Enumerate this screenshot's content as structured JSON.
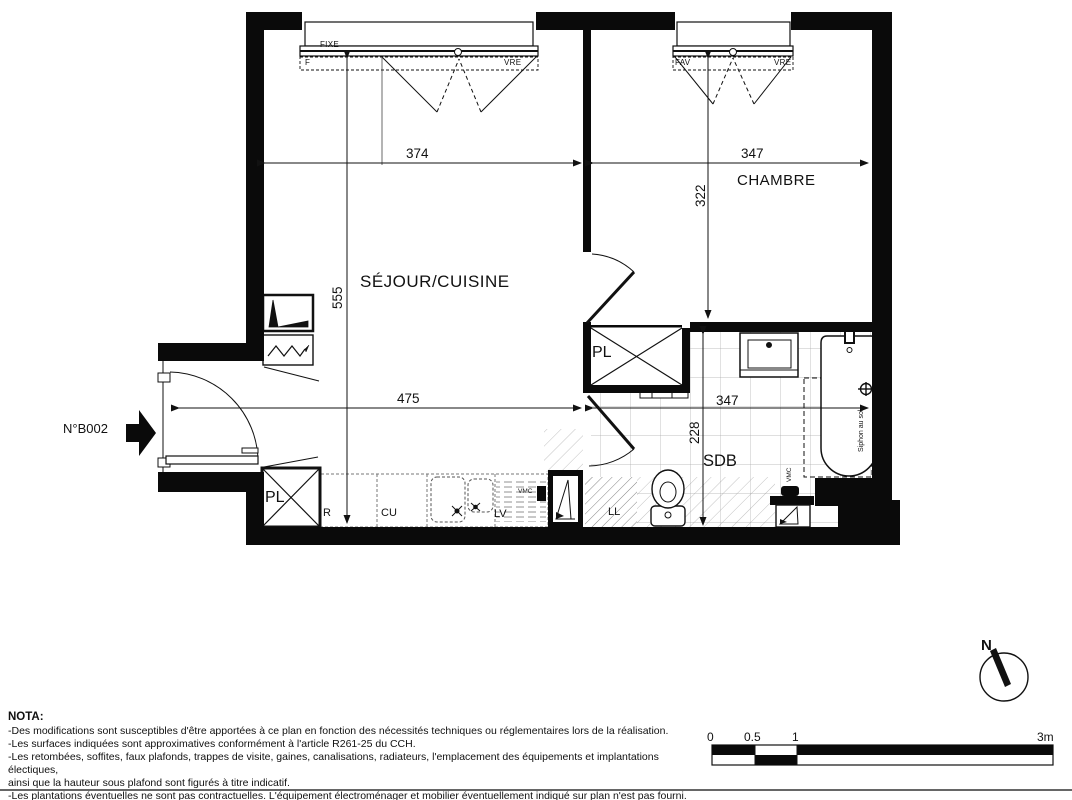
{
  "unit": {
    "label": "N°B002"
  },
  "rooms": {
    "sejour": "SÉJOUR/CUISINE",
    "chambre": "CHAMBRE",
    "sdb": "SDB",
    "pl_top": "PL",
    "pl_bottom": "PL"
  },
  "dimensions": {
    "sejour_width": "374",
    "chambre_width": "347",
    "chambre_depth": "322",
    "sejour_depth": "555",
    "entry_span": "475",
    "sdb_width": "347",
    "sdb_depth": "228"
  },
  "windows": {
    "w1_top": "FIXE",
    "w1_left": "F",
    "w1_right": "VRE",
    "w2_left": "FAV",
    "w2_right": "VRE"
  },
  "equipment": {
    "fridge": "R",
    "cooktop": "CU",
    "dishwasher": "LV",
    "washer": "LL",
    "vmc_kitchen": "VMC",
    "vmc_sdb": "VMC",
    "siphon": "Siphon au sol"
  },
  "nota": {
    "title": "NOTA:",
    "lines": [
      "-Des modifications sont susceptibles d'être apportées à ce plan en fonction des nécessités techniques ou réglementaires lors de la réalisation.",
      "-Les surfaces indiquées sont approximatives conformément à l'article R261-25 du CCH.",
      "-Les retombées, soffites, faux plafonds, trappes de visite, gaines, canalisations, radiateurs, l'emplacement des équipements et implantations électiques,",
      "ainsi que la hauteur sous plafond sont figurés à titre indicatif.",
      "-Les plantations éventuelles ne sont pas contractuelles. L'équipement électroménager et mobilier éventuellement indiqué sur plan n'est pas fourni."
    ]
  },
  "scale_bar": {
    "t0": "0",
    "t05": "0.5",
    "t1": "1",
    "t3": "3m"
  },
  "compass": {
    "north": "N"
  },
  "colors": {
    "line": "#111111",
    "wall": "#0a0a0a",
    "tile": "#aaaaaa",
    "hatch": "#777777"
  }
}
